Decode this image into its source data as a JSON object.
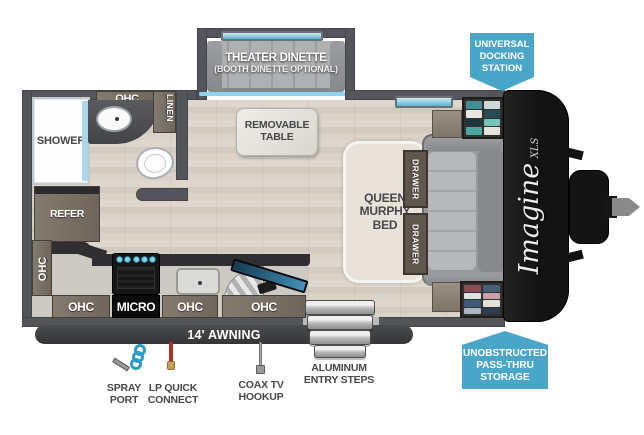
{
  "colors": {
    "accent_blue": "#4aa6c8",
    "wall_gray": "#54555a",
    "label_gray": "#46474a"
  },
  "badges": {
    "docking": {
      "lines": [
        "UNIVERSAL",
        "DOCKING",
        "STATION"
      ]
    },
    "storage": {
      "lines": [
        "UNOBSTRUCTED",
        "PASS-THRU",
        "STORAGE"
      ]
    }
  },
  "slideout": {
    "title": "THEATER DINETTE",
    "subtitle": "(BOOTH DINETTE OPTIONAL)"
  },
  "table": {
    "lines": [
      "REMOVABLE",
      "TABLE"
    ]
  },
  "bathroom": {
    "shower": "SHOWER",
    "ohc": "OHC",
    "linen": "LINEN"
  },
  "kitchen": {
    "refer": "REFER",
    "ohc_side": "OHC",
    "cabinets": [
      {
        "label": "OHC"
      },
      {
        "label": "MICRO"
      },
      {
        "label": "OHC"
      },
      {
        "label": "OHC"
      }
    ]
  },
  "bed": {
    "lines": [
      "QUEEN",
      "MURPHY",
      "BED"
    ]
  },
  "sofa": {
    "drawer_top": "DRAWER",
    "drawer_bottom": "DRAWER"
  },
  "awning": {
    "label": "14' AWNING"
  },
  "hookups": {
    "spray": {
      "lines": [
        "SPRAY",
        "PORT"
      ]
    },
    "lp": {
      "lines": [
        "LP QUICK",
        "CONNECT"
      ]
    },
    "coax": {
      "lines": [
        "COAX TV",
        "HOOKUP"
      ]
    },
    "steps": {
      "lines": [
        "ALUMINUM",
        "ENTRY STEPS"
      ]
    }
  },
  "brand": {
    "name": "Imagine",
    "series": "XLS"
  }
}
